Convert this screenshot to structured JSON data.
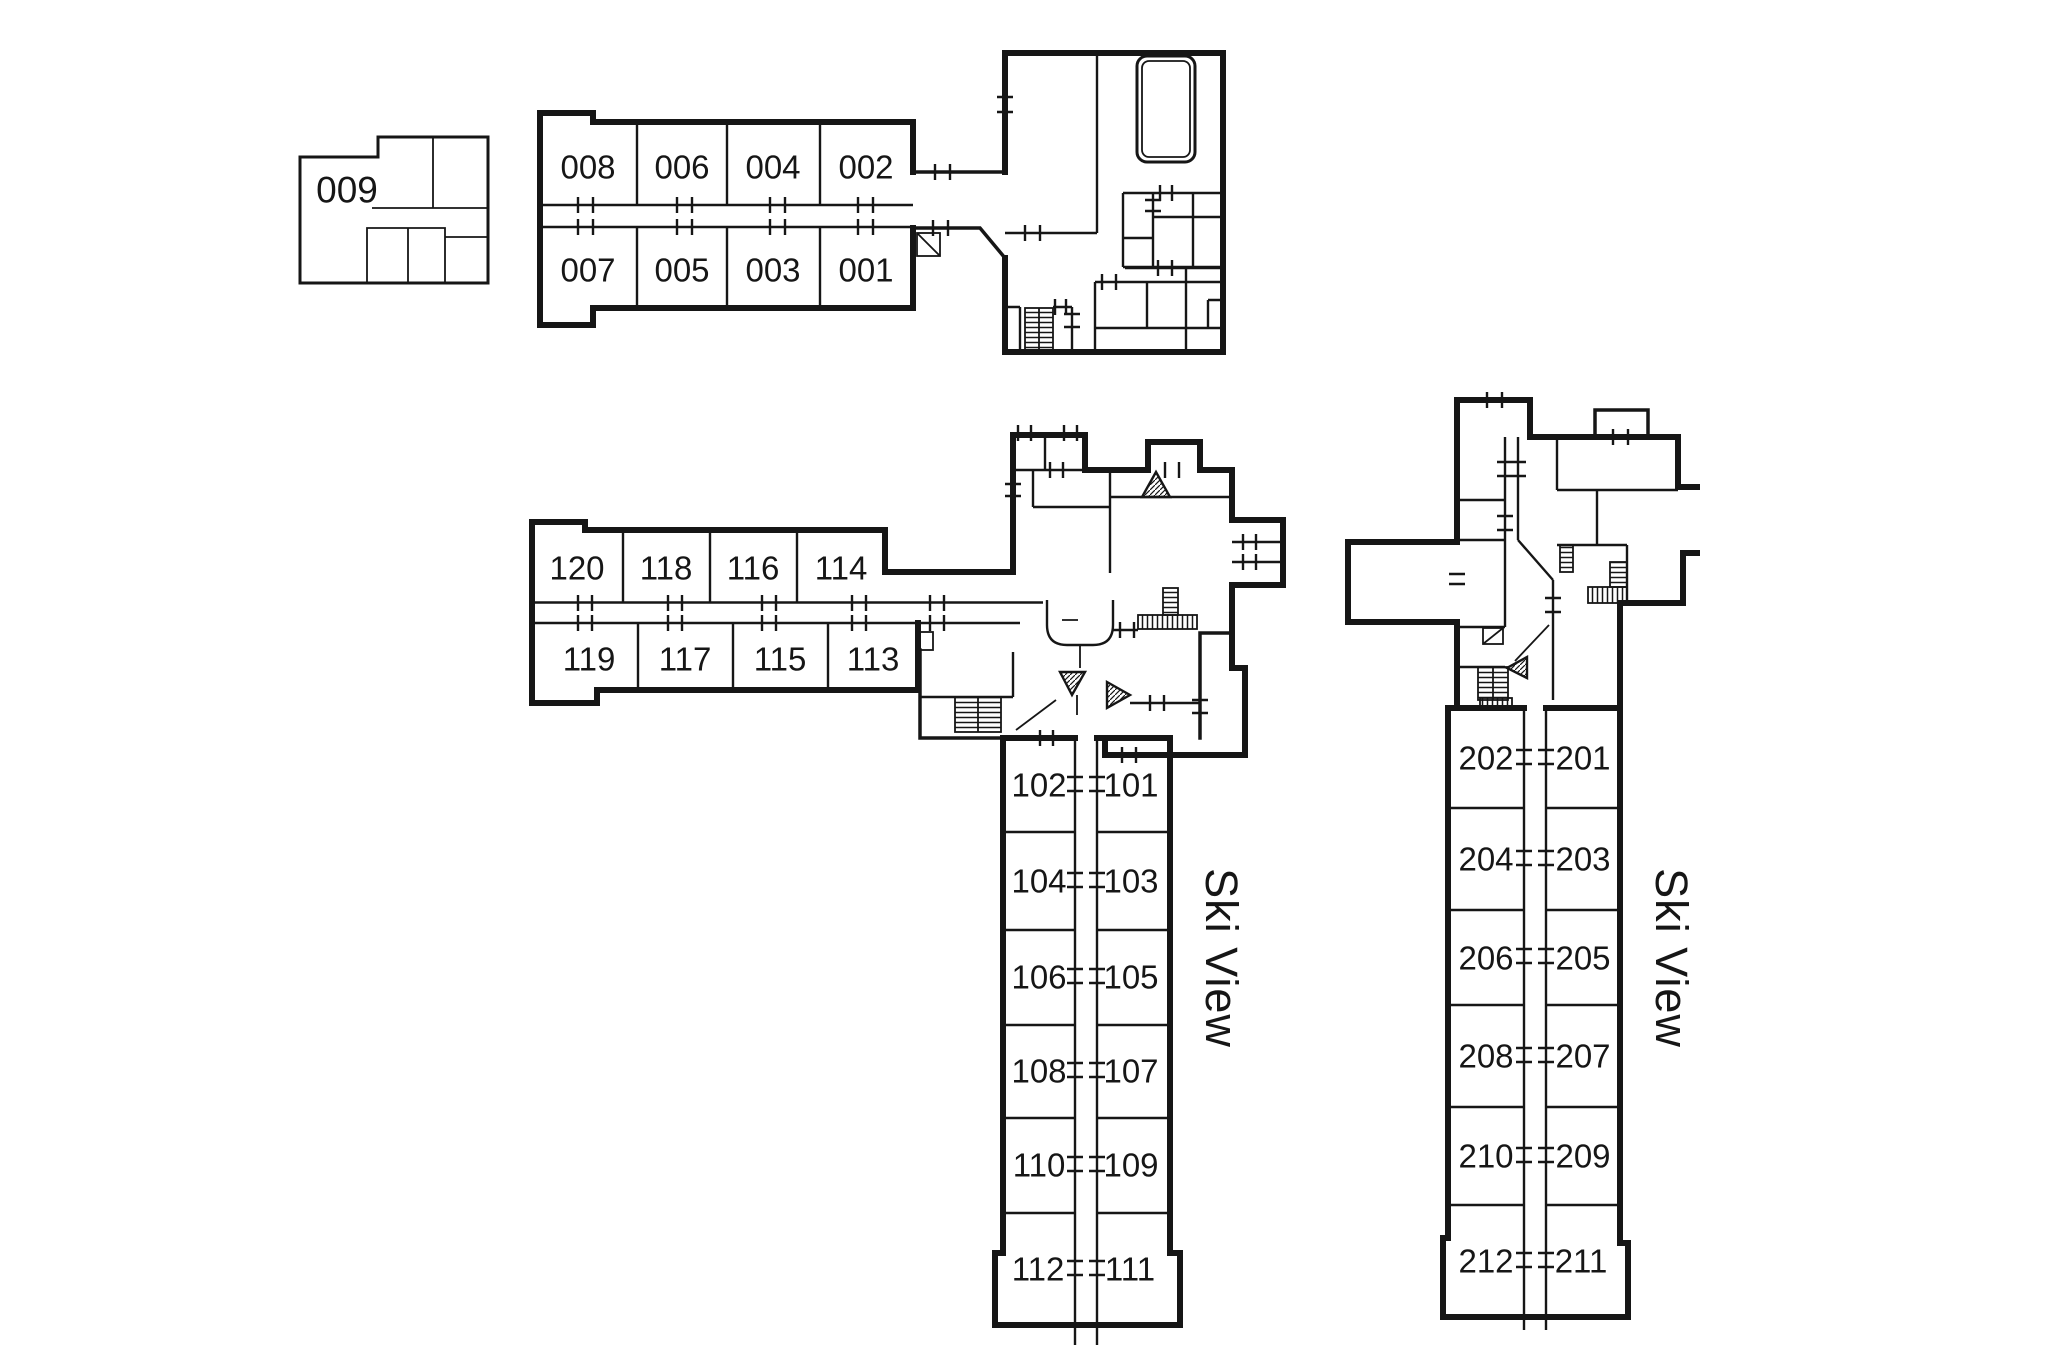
{
  "colors": {
    "background": "#ffffff",
    "ink": "#161616"
  },
  "unit_009": {
    "label": "009"
  },
  "ground_wing": {
    "top_row": [
      "008",
      "006",
      "004",
      "002"
    ],
    "bottom_row": [
      "007",
      "005",
      "003",
      "001"
    ]
  },
  "upper_wing": {
    "top_row": [
      "120",
      "118",
      "116",
      "114"
    ],
    "bottom_row": [
      "119",
      "117",
      "115",
      "113"
    ]
  },
  "tower_100s": {
    "west": [
      "102",
      "104",
      "106",
      "108",
      "110",
      "112"
    ],
    "east": [
      "101",
      "103",
      "105",
      "107",
      "109",
      "111"
    ]
  },
  "tower_200s": {
    "west": [
      "202",
      "204",
      "206",
      "208",
      "210",
      "212"
    ],
    "east": [
      "201",
      "203",
      "205",
      "207",
      "209",
      "211"
    ]
  },
  "annotations": {
    "ski_view_100s": "Ski View",
    "ski_view_200s": "Ski View"
  }
}
